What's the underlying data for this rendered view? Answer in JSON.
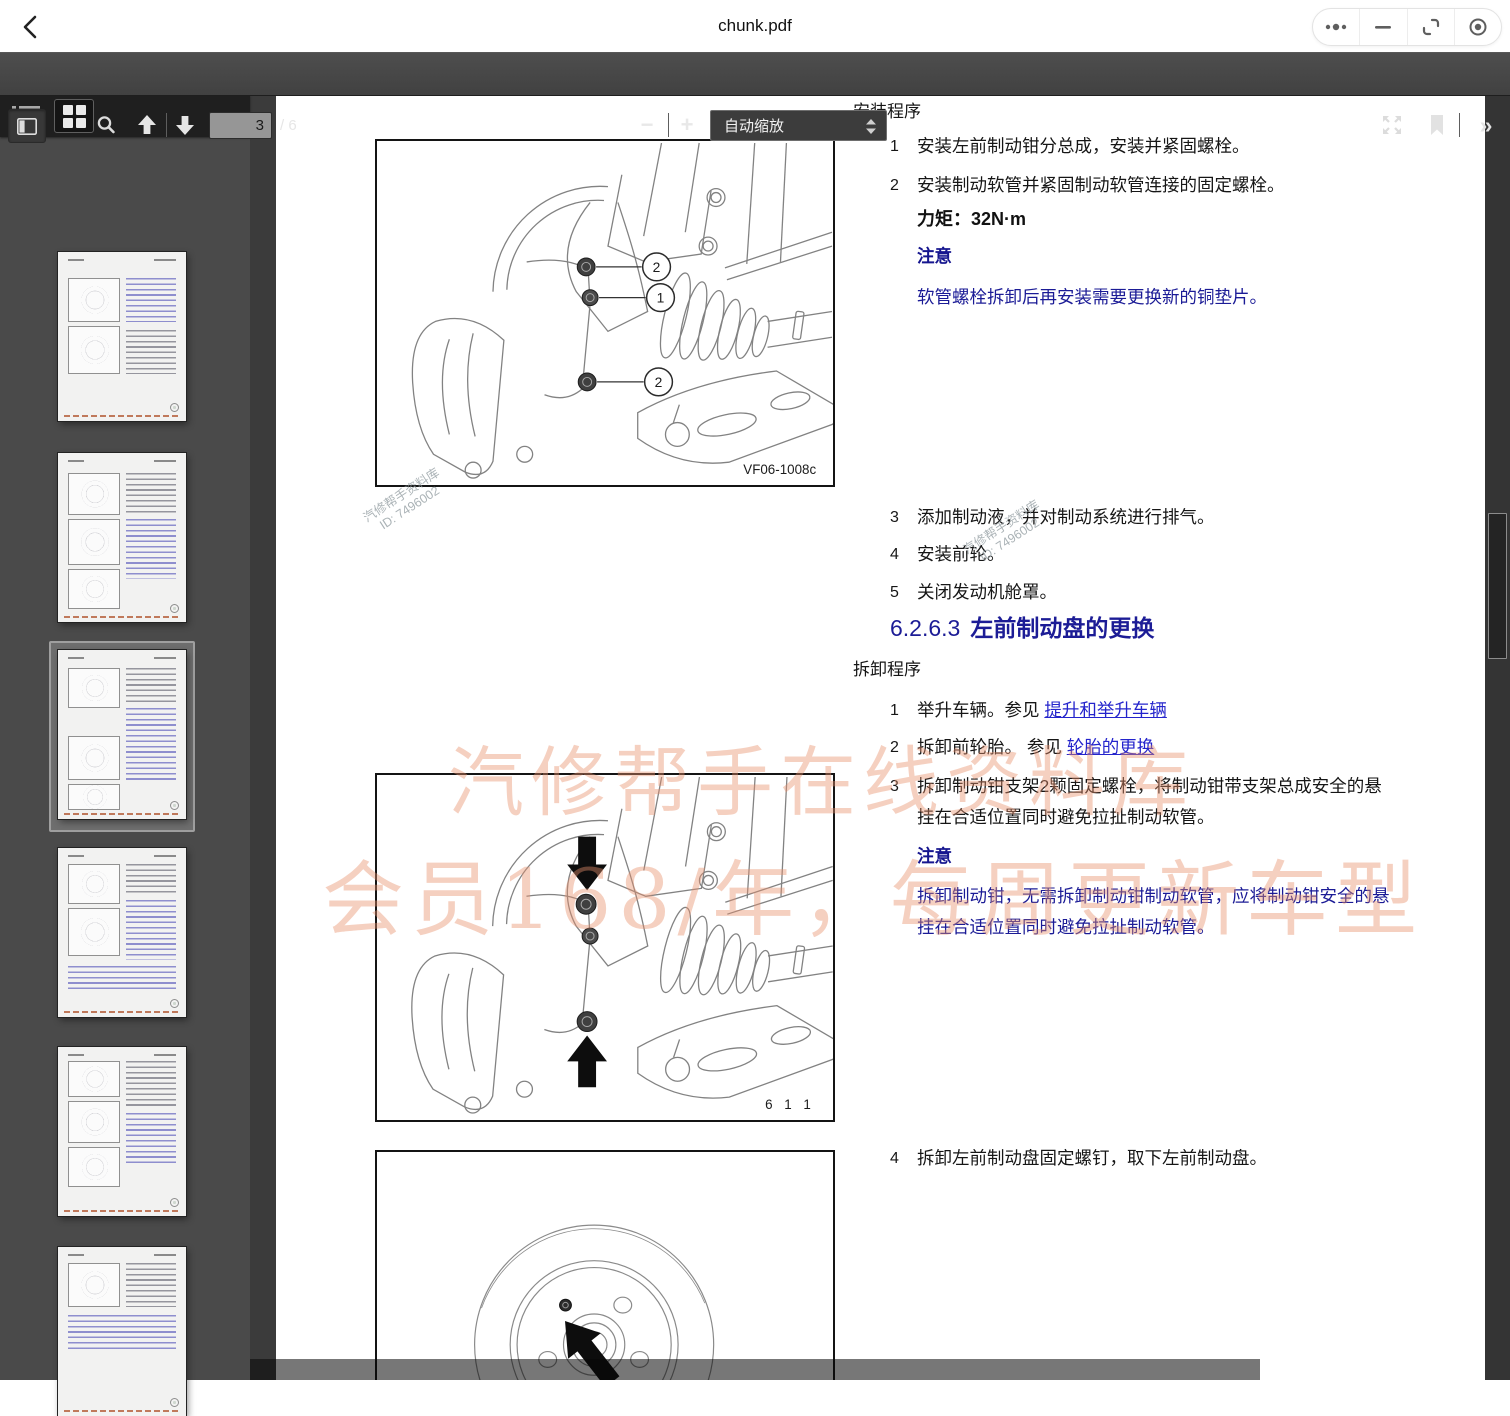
{
  "window": {
    "title": "chunk.pdf"
  },
  "toolbar": {
    "page_input_value": "3",
    "page_total": "/ 6",
    "zoom_out_label": "−",
    "zoom_in_label": "+",
    "zoom_select_label": "自动缩放",
    "more_chevron": "»"
  },
  "sidebar": {
    "active_thumbnail_index": 3,
    "thumbnail_count": 6
  },
  "page": {
    "install": {
      "header": "安装程序",
      "steps": [
        {
          "num": "1",
          "text": "安装左前制动钳分总成，安装并紧固螺栓。"
        },
        {
          "num": "2",
          "text": "安装制动软管并紧固制动软管连接的固定螺栓。"
        }
      ],
      "torque": "力矩：32N·m",
      "note_label": "注意",
      "note_text": "软管螺栓拆卸后再安装需要更换新的铜垫片。",
      "steps2": [
        {
          "num": "3",
          "text": "添加制动液，并对制动系统进行排气。"
        },
        {
          "num": "4",
          "text": "安装前轮。"
        },
        {
          "num": "5",
          "text": "关闭发动机舱罩。"
        }
      ]
    },
    "section": {
      "number": "6.2.6.3",
      "title": "左前制动盘的更换"
    },
    "removal": {
      "header": "拆卸程序",
      "steps": [
        {
          "num": "1",
          "pre": "举升车辆。参见 ",
          "link": "提升和举升车辆"
        },
        {
          "num": "2",
          "pre": "拆卸前轮胎。 参见 ",
          "link": "轮胎的更换"
        },
        {
          "num": "3",
          "text": "拆卸制动钳支架2颗固定螺栓，将制动钳带支架总成安全的悬挂在合适位置同时避免拉扯制动软管。"
        }
      ],
      "note_label": "注意",
      "note_text": "拆卸制动钳，无需拆卸制动钳制动软管，应将制动钳安全的悬挂在合适位置同时避免拉扯制动软管。",
      "step4": {
        "num": "4",
        "text": "拆卸左前制动盘固定螺钉，取下左前制动盘。"
      }
    },
    "figures": [
      {
        "caption": "VF06-1008c",
        "callouts": [
          "2",
          "1",
          "2"
        ]
      },
      {
        "caption": "6  1  1"
      },
      {
        "caption": ""
      }
    ],
    "watermarks": {
      "stamp_line1": "汽修帮手资料库",
      "stamp_line2": "ID: 7496002",
      "banner_line1": "汽修帮手在线资料库",
      "banner_line2": "会员168/年，每周更新车型"
    }
  },
  "colors": {
    "toolbar_bg": "#474747",
    "viewer_bg": "#3b3b3b",
    "heading_blue": "#1c1c96",
    "note_blue": "#16168f",
    "link_blue": "#2424cc",
    "watermark_salmon": "#e8906c"
  }
}
